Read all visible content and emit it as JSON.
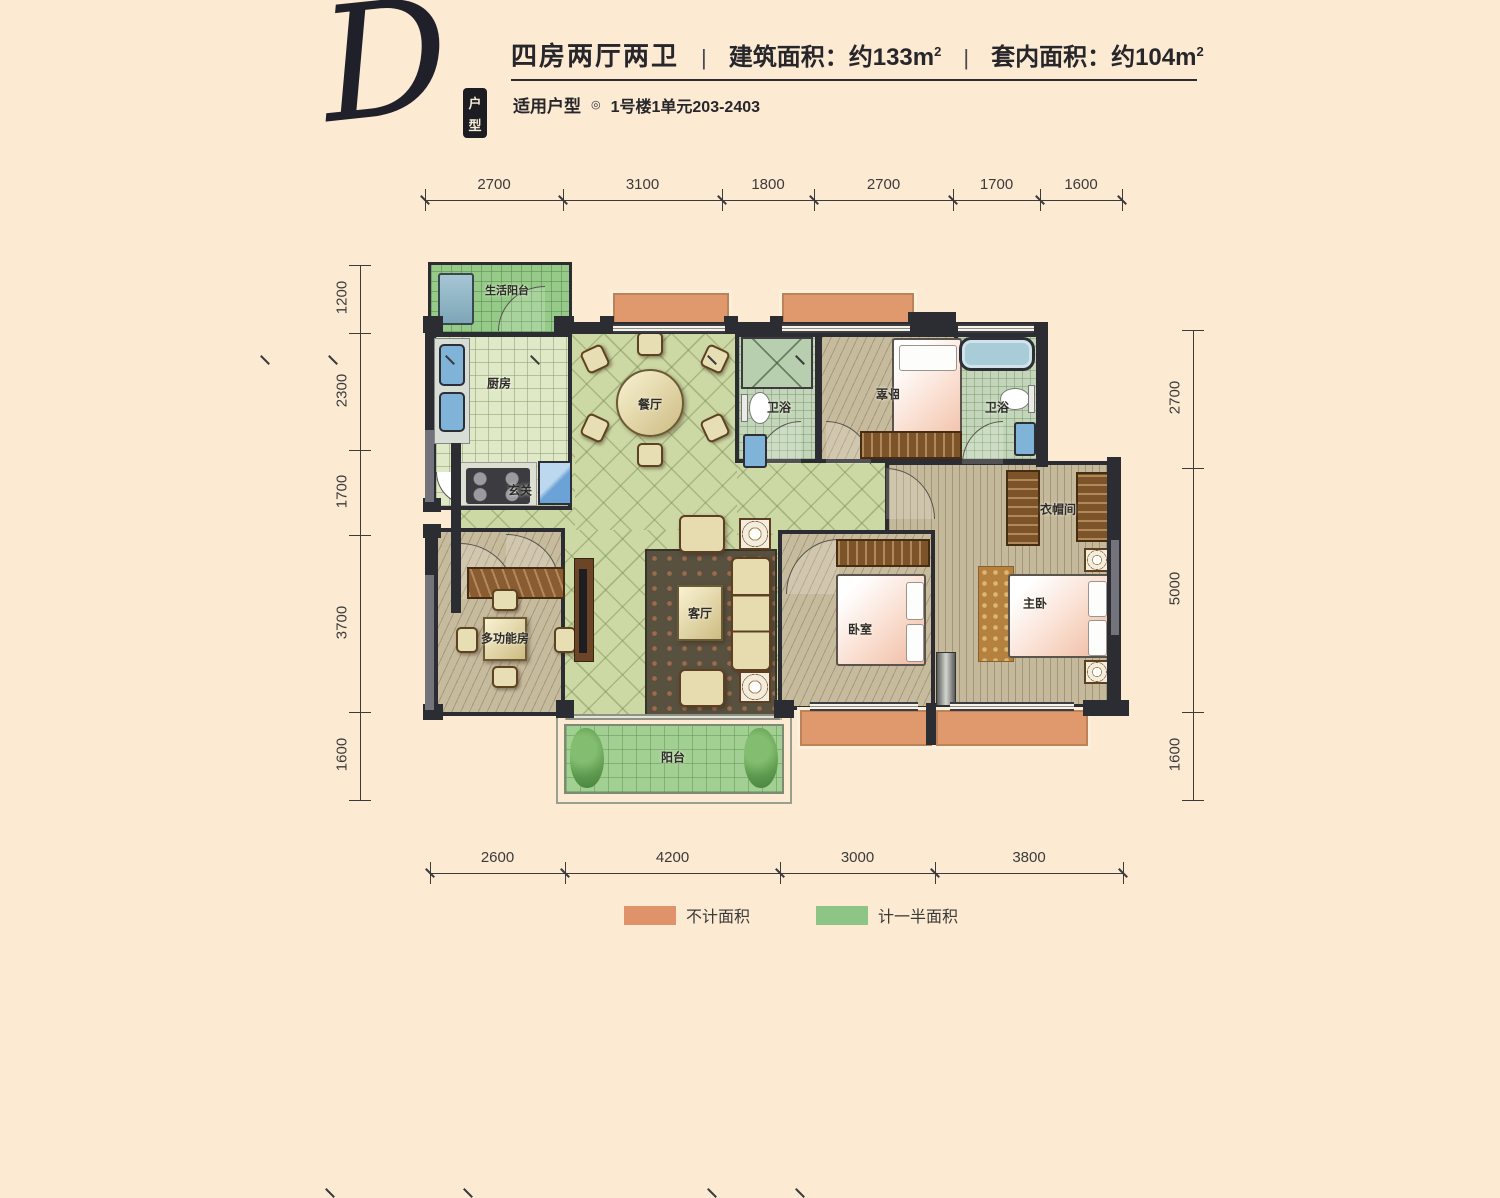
{
  "header": {
    "letter": "D",
    "seal": "户型",
    "title": "四房两厅两卫",
    "separator": "|",
    "building_area": "建筑面积：约133m",
    "building_area_sup": "2",
    "inner_area": "套内面积：约104m",
    "inner_area_sup": "2",
    "subtitle_label": "适用户型",
    "subtitle_bullet": "◎",
    "subtitle_value": "1号楼1单元203-2403"
  },
  "rooms": {
    "service_balcony": "生活阳台",
    "kitchen": "厨房",
    "dining": "餐厅",
    "hall": "玄关",
    "bath1": "卫浴",
    "bedroom_top": "卧室",
    "bath2": "卫浴",
    "multi": "多功能房",
    "living": "客厅",
    "bedroom_bottom": "卧室",
    "master": "主卧",
    "closet": "衣帽间",
    "balcony": "阳台"
  },
  "dimensions": {
    "top": [
      "2700",
      "3100",
      "1800",
      "2700",
      "1700",
      "1600"
    ],
    "bottom": [
      "2600",
      "4200",
      "3000",
      "3800"
    ],
    "left": [
      "1200",
      "2300",
      "1700",
      "3700",
      "1600"
    ],
    "right": [
      "2700",
      "5000",
      "1600"
    ]
  },
  "legend": {
    "items": [
      {
        "label": "不计面积",
        "color": "#e0926a"
      },
      {
        "label": "计一半面积",
        "color": "#8cc585"
      }
    ]
  }
}
